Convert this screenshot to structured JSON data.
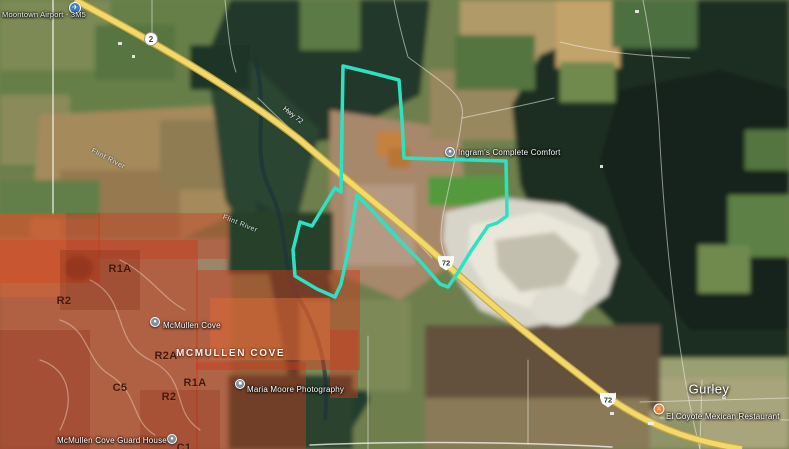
{
  "colors": {
    "parcel-outline": "#2be3c3",
    "zoning-fill": "#c83c1e",
    "zoning-bright": "#e06a35",
    "highway-fill": "#f2d96b",
    "highway-casing": "#c9a83c",
    "airport-pin": "#3d7fc2",
    "restaurant-pin": "#e8833a",
    "poi-pin": "#7d8f9b"
  },
  "pois": {
    "airport": {
      "label": "Moontown Airport - 3M5"
    },
    "ingrams": {
      "label": "Ingram's Complete Comfort"
    },
    "mcmullen_cove": {
      "label": "McMullen Cove"
    },
    "maria_moore": {
      "label": "Maria Moore Photography"
    },
    "guard_house": {
      "label": "McMullen Cove Guard House"
    },
    "el_coyote": {
      "label": "El Coyote Mexican Restaurant"
    }
  },
  "places": {
    "town": "Gurley",
    "neighborhood": "MCMULLEN COVE"
  },
  "water": {
    "river1": "Flint River",
    "river2": "Flint River"
  },
  "roads": {
    "label": "Hwy 72",
    "shield_circle": "2",
    "shield_us1": "72",
    "shield_us2": "72"
  },
  "zoning": {
    "z1": "R1A",
    "z2": "R2",
    "z3": "R2A",
    "z4": "C5",
    "z5": "R1A",
    "z6": "R2",
    "z7": "C1"
  }
}
